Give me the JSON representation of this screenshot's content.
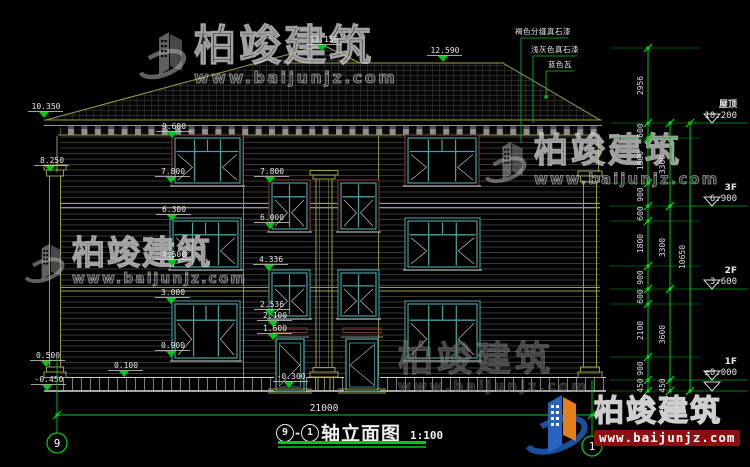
{
  "watermark": {
    "brand": "柏竣建筑",
    "url": "www.baijunjz.com"
  },
  "logo": {
    "brand": "柏竣建筑",
    "url": "www.baijunjz.com"
  },
  "title_block": {
    "axis_left": "9",
    "axis_sep": "-",
    "axis_right": "1",
    "name": "轴立面图",
    "scale": "1:100"
  },
  "bottom_dimension": {
    "label": "21000",
    "x1": 57,
    "x2": 592,
    "y": 415,
    "tx": 324,
    "ty": 411
  },
  "grid_bubbles": [
    {
      "label": "9",
      "x": 57,
      "cy": 443,
      "lineTop": 357
    },
    {
      "label": "1",
      "x": 592,
      "cy": 446,
      "lineTop": 380
    }
  ],
  "material_callouts": [
    {
      "text": "褐色分缝真石漆",
      "tx": 543,
      "ty": 31,
      "lx": 521,
      "uy": 38,
      "ux2": 568,
      "ly2": 143,
      "dot": false
    },
    {
      "text": "浅灰色真石漆",
      "tx": 555,
      "ty": 49,
      "lx": 533,
      "uy": 56,
      "ux2": 577,
      "ly2": 123,
      "dot": false
    },
    {
      "text": "蓝色瓦",
      "tx": 560,
      "ty": 64,
      "lx": 546,
      "uy": 71,
      "ux2": 574,
      "ly2": 97,
      "dot": true
    }
  ],
  "elevation_markers": [
    {
      "label": "13.156",
      "x": 322,
      "y": 51
    },
    {
      "label": "12.590",
      "x": 443,
      "y": 62
    },
    {
      "label": "10.350",
      "x": 44,
      "y": 118
    },
    {
      "label": "9.600",
      "x": 172,
      "y": 138
    },
    {
      "label": "8.250",
      "x": 50,
      "y": 172
    },
    {
      "label": "7.800",
      "x": 171,
      "y": 183
    },
    {
      "label": "7.800",
      "x": 270,
      "y": 183
    },
    {
      "label": "6.300",
      "x": 172,
      "y": 221
    },
    {
      "label": "6.000",
      "x": 270,
      "y": 229
    },
    {
      "label": "4.500",
      "x": 172,
      "y": 266
    },
    {
      "label": "4.336",
      "x": 269,
      "y": 271
    },
    {
      "label": "3.000",
      "x": 171,
      "y": 304
    },
    {
      "label": "2.536",
      "x": 270,
      "y": 316
    },
    {
      "label": "2.100",
      "x": 273,
      "y": 327
    },
    {
      "label": "1.600",
      "x": 273,
      "y": 340
    },
    {
      "label": "0.900",
      "x": 171,
      "y": 357
    },
    {
      "label": "0.500",
      "x": 46,
      "y": 367
    },
    {
      "label": "0.100",
      "x": 124,
      "y": 377
    },
    {
      "label": "-0.450",
      "x": 47,
      "y": 391
    },
    {
      "label": "-0.300",
      "x": 289,
      "y": 388
    }
  ],
  "dimension_chains": [
    {
      "x": 648,
      "segments": [
        {
          "label": "2956",
          "y1": 48,
          "y2": 123
        },
        {
          "label": "600",
          "y1": 123,
          "y2": 138
        },
        {
          "label": "1800",
          "y1": 138,
          "y2": 183
        },
        {
          "label": "900",
          "y1": 183,
          "y2": 206
        },
        {
          "label": "600",
          "y1": 206,
          "y2": 221
        },
        {
          "label": "1800",
          "y1": 221,
          "y2": 266
        },
        {
          "label": "900",
          "y1": 266,
          "y2": 289
        },
        {
          "label": "600",
          "y1": 289,
          "y2": 304
        },
        {
          "label": "2100",
          "y1": 304,
          "y2": 357
        },
        {
          "label": "900",
          "y1": 357,
          "y2": 380
        },
        {
          "label": "450",
          "y1": 380,
          "y2": 391
        }
      ]
    },
    {
      "x": 670,
      "segments": [
        {
          "label": "3300",
          "y1": 123,
          "y2": 206
        },
        {
          "label": "3300",
          "y1": 206,
          "y2": 289
        },
        {
          "label": "3600",
          "y1": 289,
          "y2": 380
        },
        {
          "label": "450",
          "y1": 380,
          "y2": 391
        }
      ]
    },
    {
      "x": 690,
      "segments": [
        {
          "label": "10650",
          "y1": 123,
          "y2": 391
        }
      ]
    }
  ],
  "floor_levels": [
    {
      "name": "屋顶",
      "value": "10.200",
      "y": 123
    },
    {
      "name": "3F",
      "value": "6.900",
      "y": 206
    },
    {
      "name": "2F",
      "value": "3.600",
      "y": 289
    },
    {
      "name": "1F",
      "value": "±0.000",
      "y": 380
    },
    {
      "name": "",
      "value": "",
      "y": 391
    }
  ]
}
